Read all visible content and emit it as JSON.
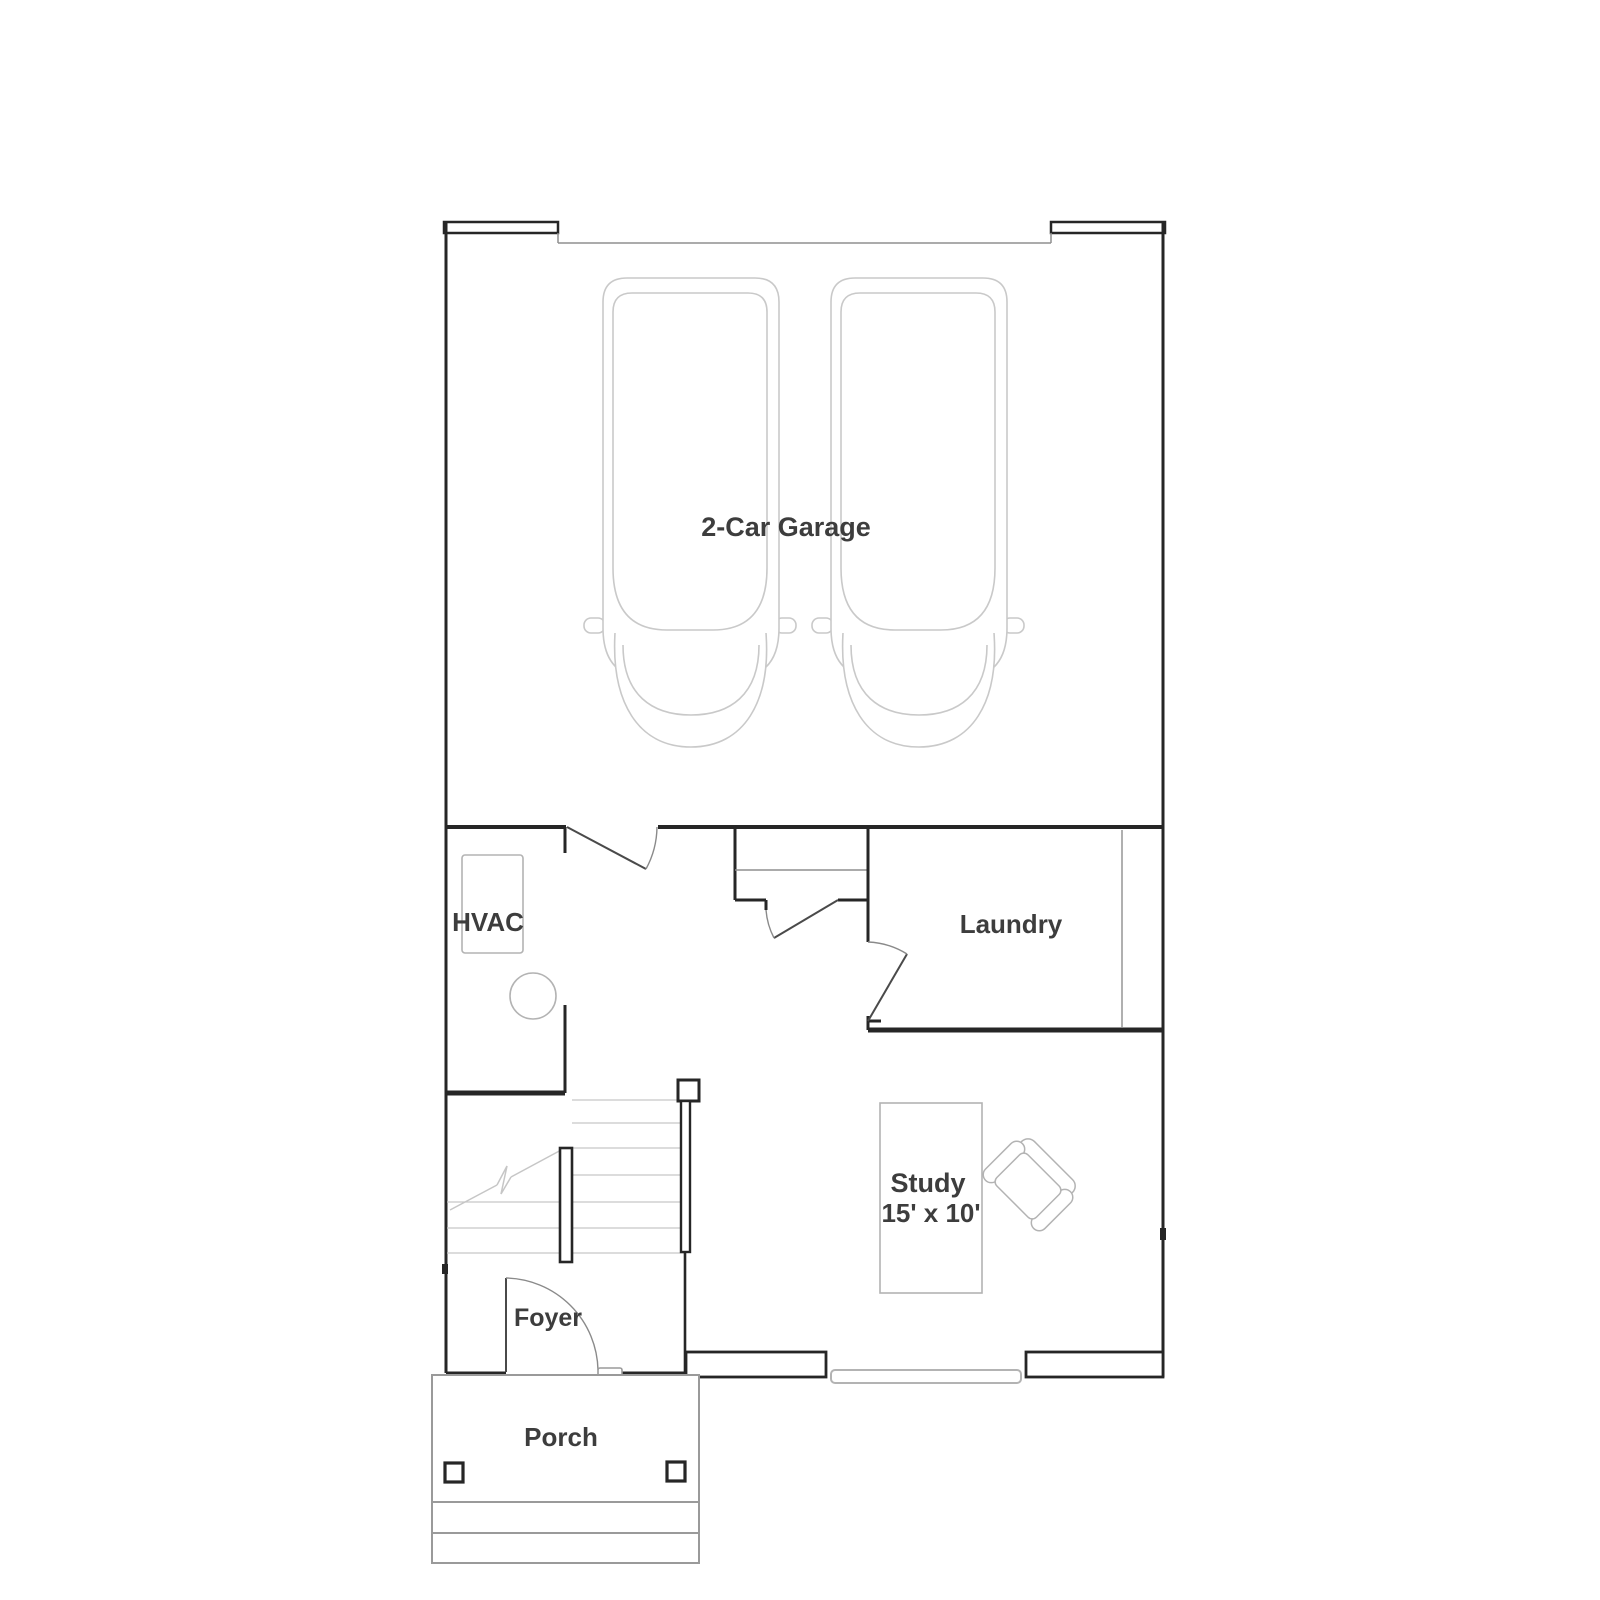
{
  "floorplan": {
    "rooms": [
      {
        "key": "garage",
        "label": "2-Car Garage"
      },
      {
        "key": "hvac",
        "label": "HVAC"
      },
      {
        "key": "laundry",
        "label": "Laundry"
      },
      {
        "key": "study",
        "label": "Study",
        "dims": "15' x 10'"
      },
      {
        "key": "foyer",
        "label": "Foyer"
      },
      {
        "key": "porch",
        "label": "Porch"
      }
    ],
    "colors": {
      "wall": "#262626",
      "door_leaf": "#4a4a4a",
      "door_arc": "#8a8a8a",
      "fixture_outline": "#b3b3b3",
      "car_outline": "#c9c9c9",
      "stair_tread": "#c6c6c6",
      "porch_outline": "#9a9a9a",
      "label_text": "#3d3d3d",
      "background": "#ffffff"
    }
  }
}
